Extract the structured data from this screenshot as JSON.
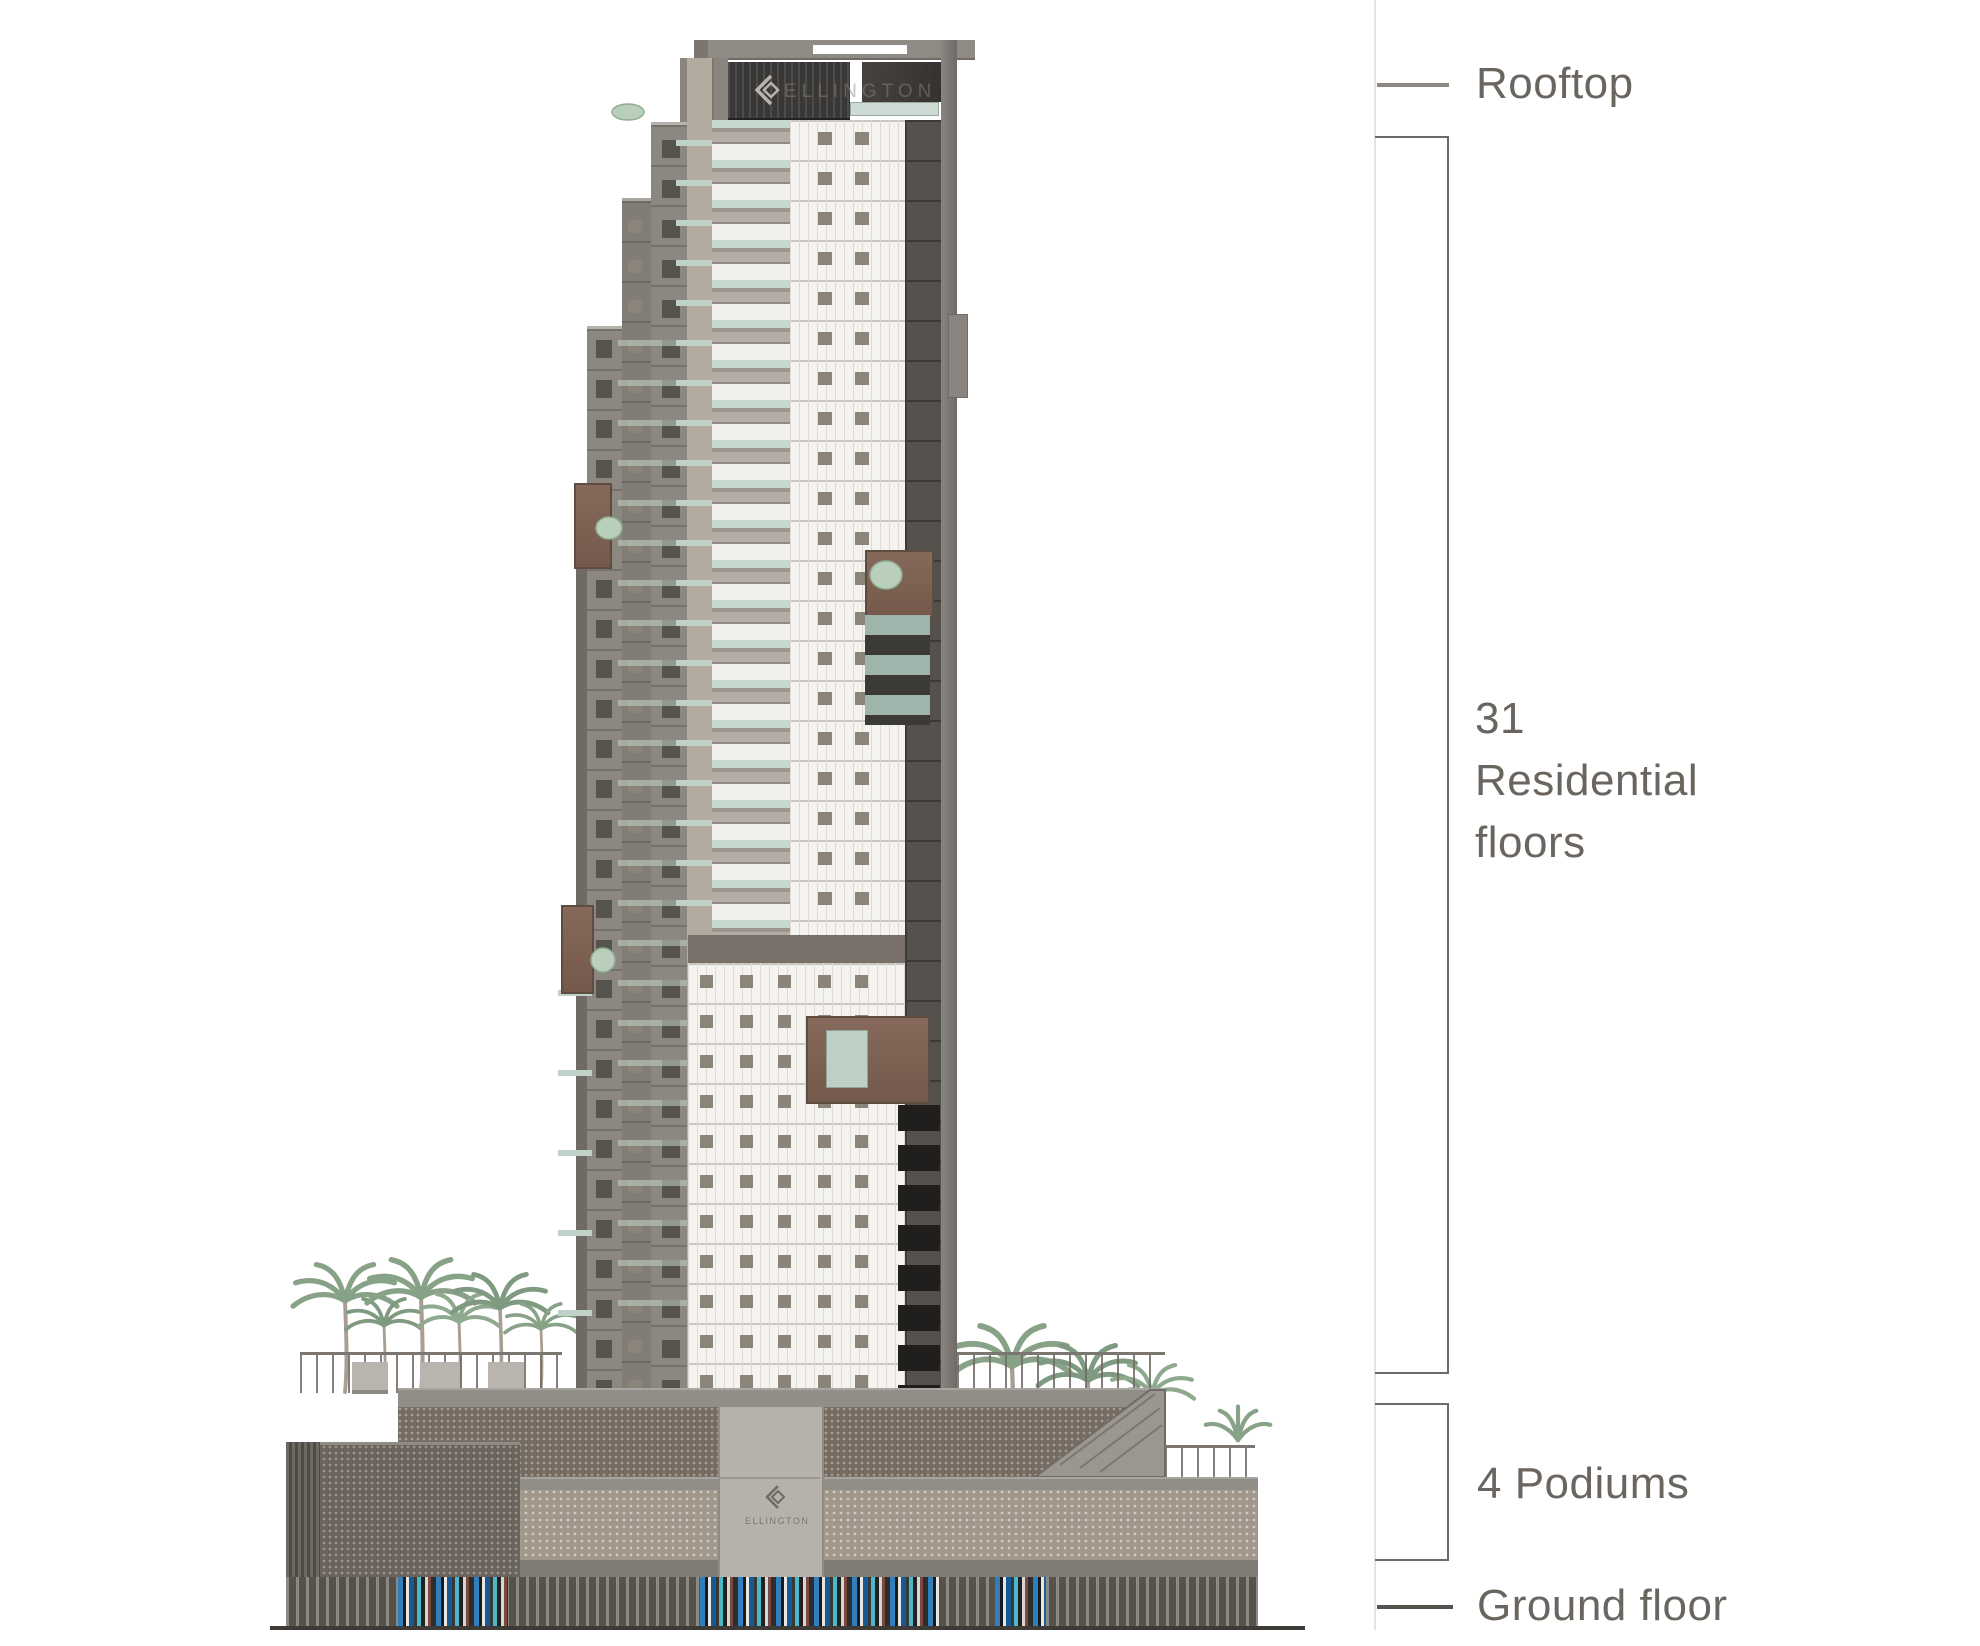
{
  "figure": {
    "type": "building-elevation-diagram",
    "annotations": {
      "rooftop": "Rooftop",
      "residential": "31\nResidential\nfloors",
      "podiums": "4 Podiums",
      "ground_floor": "Ground floor"
    },
    "branding": {
      "sign_text": "ELLINGTON",
      "entrance_text": "ELLINGTON"
    },
    "colors": {
      "label_text": "#6b6560",
      "bracket_line": "#6e6a66",
      "balcony_glass": "#c6d7cd",
      "facade_white": "#f4f3f0",
      "facade_gray": "#8c8781",
      "dark_sign_band": "#3a3836",
      "mesh_tan": "#a1978b",
      "mesh_dark": "#6b645c",
      "accent_blue": "#2f7fc0",
      "accent_blue_dark": "#155a96",
      "accent_teal": "#49b8c8",
      "palm_green": "#87a287"
    }
  }
}
